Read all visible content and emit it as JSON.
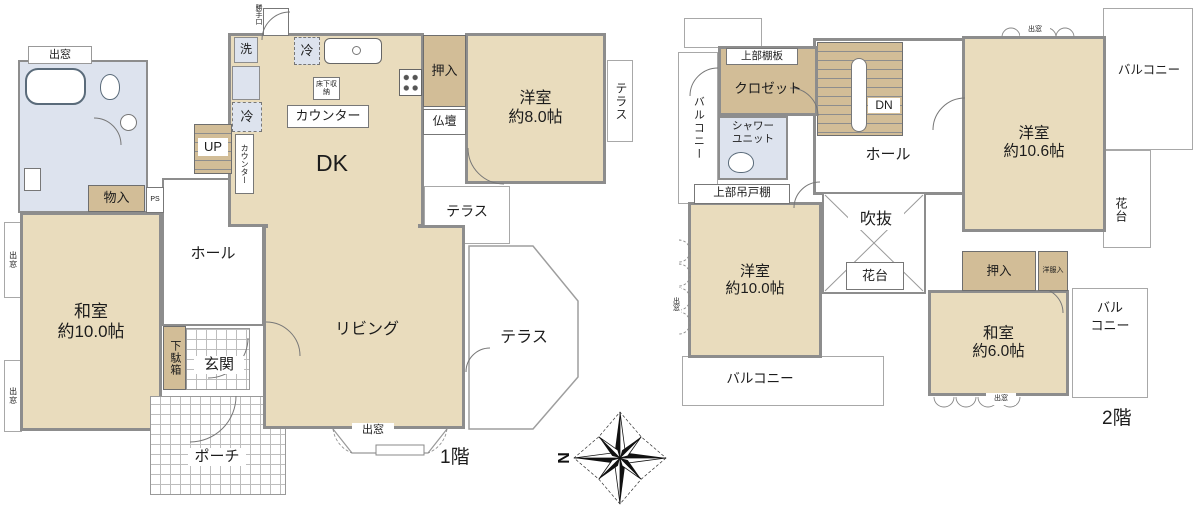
{
  "palette": {
    "room_fill": "#e9dcbd",
    "storage_fill": "#d2bd97",
    "wet_area_fill": "#dde3ee",
    "wall": "#8d8d8d",
    "tile_line": "#bdbdbd"
  },
  "compass": {
    "north": "N"
  },
  "shared": {
    "demado": "出窓",
    "terrace": "テラス",
    "balcony": "バルコニー",
    "kadai": "花台",
    "oshiire": "押入",
    "hall": "ホール"
  },
  "floor1": {
    "label": "1階",
    "washitsu_name": "和室",
    "washitsu_size": "約10.0帖",
    "yoshitsu_name": "洋室",
    "yoshitsu_size": "約8.0帖",
    "living": "リビング",
    "dk": "DK",
    "genkan": "玄関",
    "porch": "ポーチ",
    "monoiri": "物入",
    "ps": "PS",
    "getabako": "下駄箱",
    "counter": "カウンター",
    "rei": "冷",
    "sen": "洗",
    "up": "UP",
    "yukashita": "床下収納",
    "butsudan": "仏壇",
    "katteguchi": "勝手口"
  },
  "floor2": {
    "label": "2階",
    "yoshitsu_a_name": "洋室",
    "yoshitsu_a_size": "約10.6帖",
    "yoshitsu_b_name": "洋室",
    "yoshitsu_b_size": "約10.0帖",
    "washitsu_name": "和室",
    "washitsu_size": "約6.0帖",
    "closet": "クロゼット",
    "tanaita": "上部棚板",
    "tsuridana": "上部吊戸棚",
    "shower_line1": "シャワー",
    "shower_line2": "ユニット",
    "dn": "DN",
    "fukinuke": "吹抜",
    "yofukuire": "洋服入",
    "balcony_line1": "バル",
    "balcony_line2": "コニー"
  }
}
